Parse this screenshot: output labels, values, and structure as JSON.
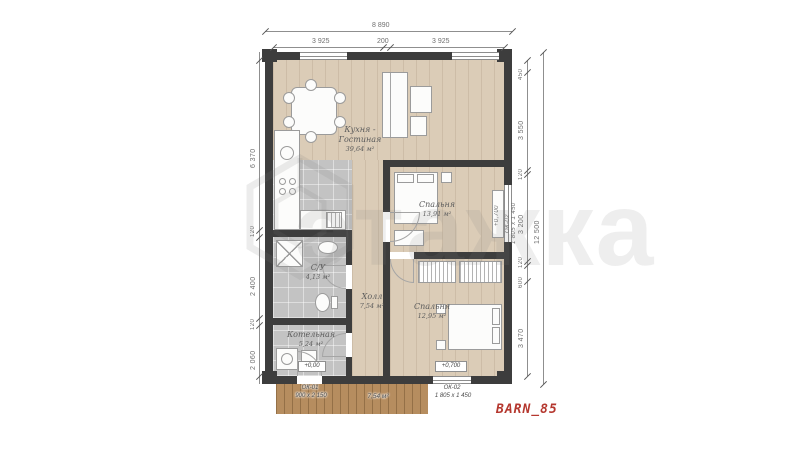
{
  "title": "BARN_85",
  "watermark": {
    "text": "этажка",
    "logo": "hexagon-logo"
  },
  "dimensions": {
    "top_overall": "8 890",
    "top_segments": [
      "3 925",
      "200",
      "3 925"
    ],
    "left_segments": [
      "6 370",
      "120",
      "2 400",
      "120",
      "2 060"
    ],
    "right_segments": [
      "450",
      "3 550",
      "120",
      "3 200",
      "120",
      "600",
      "3 470"
    ],
    "right_overall": "12 500"
  },
  "rooms": {
    "kitchen_living": {
      "name_line1": "Кухня -",
      "name_line2": "Гостиная",
      "area": "39,64 м²"
    },
    "bedroom_top": {
      "name": "Спальня",
      "area": "13,91 м²"
    },
    "bedroom_bottom": {
      "name": "Спальня",
      "area": "12,95 м²"
    },
    "hall": {
      "name": "Холл",
      "area": "7,54 м²"
    },
    "bathroom": {
      "name": "С/У",
      "area": "4,13 м²"
    },
    "boiler": {
      "name": "Котельная",
      "area": "5,24 м²"
    },
    "terrace": {
      "area": "7,54 м²"
    }
  },
  "openings": {
    "entry_door": {
      "level": "+0,00",
      "code": "ОК-01",
      "size": "900 х 2 150"
    },
    "bottom_window": {
      "level": "+0,700",
      "code": "ОК-02",
      "size": "1 805 х 1 450"
    },
    "right_window": {
      "level": "+0,700",
      "code": "ОК-02",
      "size": "1 805 х 1 450"
    }
  },
  "colors": {
    "wall": "#3d3d3d",
    "wood": "#dbccb7",
    "tile": "#c3c3c3",
    "deck": "#b68d5f",
    "dim": "#6f6f6f",
    "accent": "#b5382f",
    "watermark": "#dadada"
  }
}
